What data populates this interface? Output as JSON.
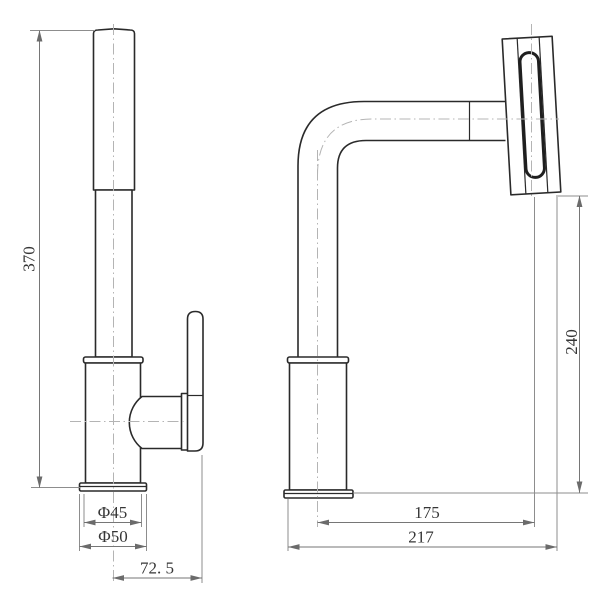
{
  "drawing": {
    "description": "faucet two-view dimension drawing",
    "colors": {
      "object_line": "#2a2a2a",
      "dimension_line": "#767676",
      "extension_line": "#8d8d8d",
      "centerline": "#b4b4b4",
      "text": "#363636",
      "background": "#ffffff"
    }
  },
  "dimensions": {
    "overall_height": "370",
    "body_diameter": "Φ45",
    "base_diameter": "Φ50",
    "handle_offset": "72. 5",
    "spout_reach": "175",
    "total_reach": "217",
    "spout_height": "240"
  }
}
